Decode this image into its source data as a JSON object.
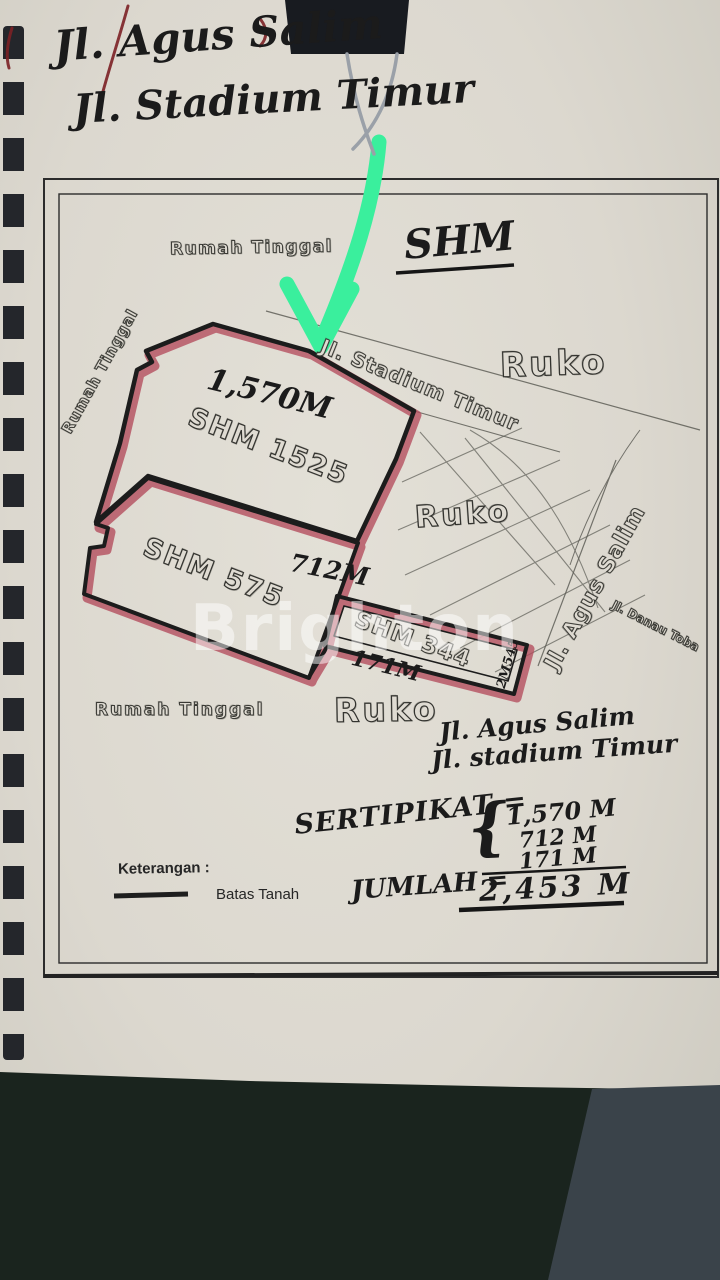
{
  "top_note": {
    "line1": "Jl. Agus Salim",
    "line2": "Jl. Stadium Timur"
  },
  "plan": {
    "shm_heading": "SHM",
    "labels": {
      "rumah_tinggal_top": "Rumah Tinggal",
      "rumah_tinggal_left": "Rumah Tinggal",
      "rumah_tinggal_bottom": "Rumah Tinggal",
      "ruko_top": "Ruko",
      "ruko_mid": "Ruko",
      "ruko_bottom": "Ruko",
      "street_stadium": "Jl. Stadium Timur",
      "street_agus": "Jl. Agus Salim",
      "street_danau": "Jl. Danau Toba"
    },
    "parcels": {
      "p1525": {
        "name": "SHM 1525",
        "area": "1,570M"
      },
      "p575": {
        "name": "SHM 575",
        "area": "712M"
      },
      "p344": {
        "name": "SHM 344",
        "area": "171M",
        "note": "2M545"
      }
    },
    "legend": {
      "heading": "Keterangan :",
      "batas": "Batas Tanah"
    },
    "bottom_note": {
      "line1": "Jl. Agus Salim",
      "line2": "Jl. stadium Timur"
    },
    "certificate": {
      "label": "SERTIPIKAT =",
      "brace": "{",
      "items": [
        "1,570 M",
        "712 M",
        "171 M"
      ],
      "total_label": "JUMLAH =",
      "total": "2,453 M"
    }
  },
  "watermark": "Brighton",
  "colors": {
    "paper": "#dcd8cf",
    "boundary_ink": "#1c1c1c",
    "boundary_highlight": "#b34b5c",
    "arrow_green": "#3aef9d",
    "fabric_dark": "#1a241e",
    "fabric_gray": "#3a434a"
  }
}
